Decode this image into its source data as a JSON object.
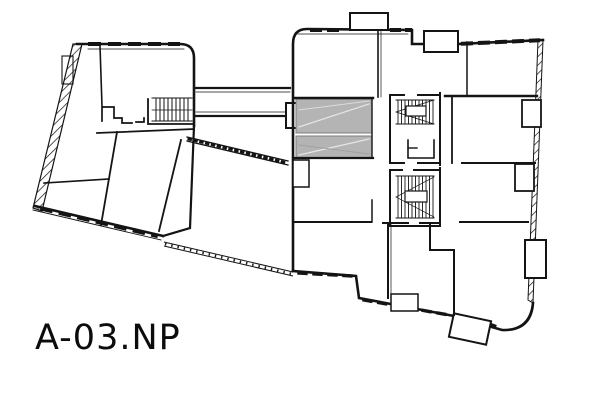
{
  "plan": {
    "label": "A-03.NP"
  },
  "colors": {
    "line": "#141414",
    "shaded_area": "#b4b4b4",
    "background": "#ffffff"
  }
}
